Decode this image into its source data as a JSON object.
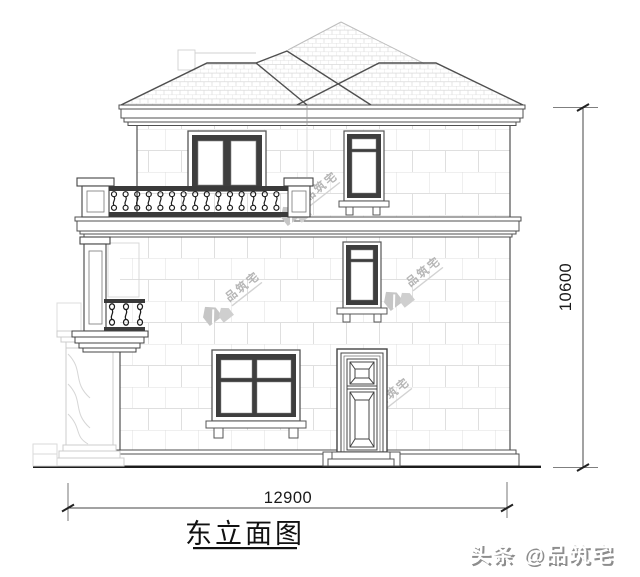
{
  "page": {
    "background": "#ffffff"
  },
  "colors": {
    "line_dark": "#4f4f4f",
    "window_frame_fill": "#3e3e3e",
    "wall_joint_line": "#dfdfdf",
    "roof_tile_line": "#d9d9d9",
    "watermark_gray": "#c4c4c4",
    "ink": "#111111"
  },
  "drawing": {
    "title": "东立面图",
    "dimensions": {
      "height": "10600",
      "width": "12900"
    },
    "watermarks": {
      "brand": "品筑宅",
      "footer": "头条 @品筑宅"
    }
  }
}
